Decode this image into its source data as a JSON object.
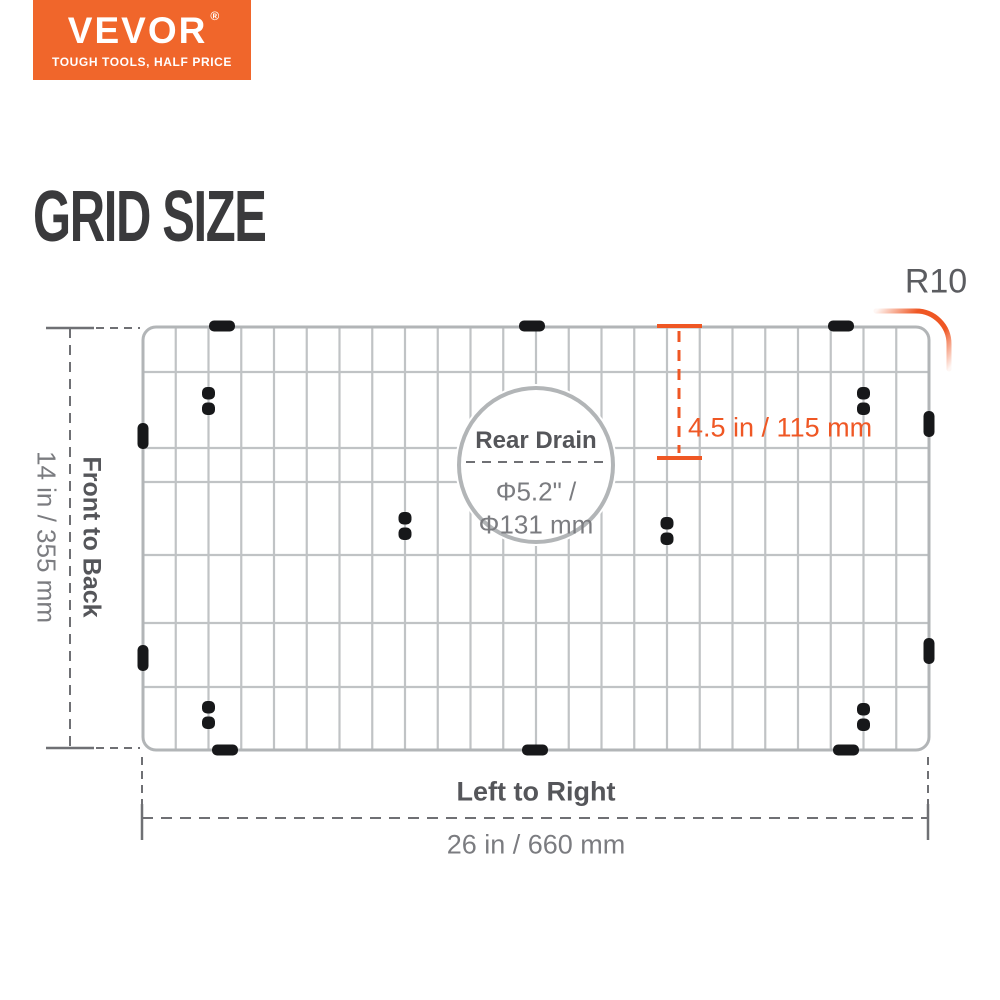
{
  "logo": {
    "brand": "VEVOR",
    "registered": "®",
    "tagline": "TOUGH TOOLS, HALF PRICE"
  },
  "title": "GRID SIZE",
  "diagram": {
    "corner_radius_label": "R10",
    "drain_offset_label": "4.5 in / 115 mm",
    "drain": {
      "title": "Rear Drain",
      "diameter_in": "Φ5.2\" /",
      "diameter_mm": "Φ131 mm"
    },
    "front_to_back_label": "Front to Back",
    "front_to_back_value": "14 in / 355 mm",
    "left_to_right_label": "Left to Right",
    "left_to_right_value": "26 in / 660 mm"
  },
  "colors": {
    "brand_orange": "#f0662b",
    "dimension_orange": "#ef5724",
    "wire_gray": "#c0c3c5",
    "rail_gray": "#b2b5b7",
    "dash_gray": "#6f7074",
    "clip_black": "#17181a",
    "title_dark": "#3a3a3c",
    "label_dark_gray": "#55565a",
    "value_gray": "#7b7c80"
  }
}
